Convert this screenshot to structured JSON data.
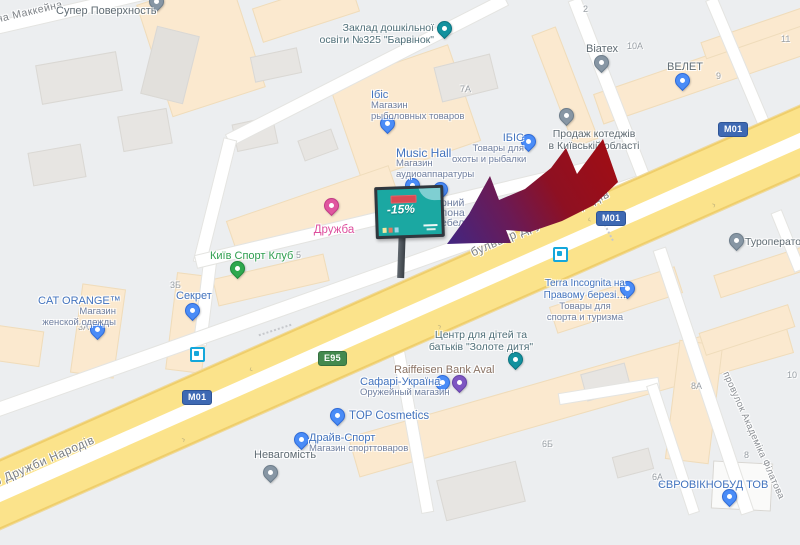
{
  "app": {
    "view": "map"
  },
  "colors": {
    "highway_yellow": "#FBE38B",
    "road_white": "#FFFFFF",
    "shield_m01_blue": "#3E69B3",
    "shield_e95_green": "#43894E",
    "shop_label_blue": "#4273BE",
    "gray_poi": "#5F6B73",
    "school_teal": "#4E6E78",
    "sport_green": "#2E9E4F",
    "entertainment_pink": "#DE4F9E",
    "bank_brown": "#8A7263",
    "arrow_red": "#A00D14",
    "arrow_purple": "#45257E",
    "billboard_teal": "#1BA8A2"
  },
  "streets": {
    "mccain": "на Маккейна",
    "boulevard": "бульвар Дружби Народів",
    "filatova": "провулок Академіка Філатова"
  },
  "shields": {
    "m01": "M01",
    "e95": "E95"
  },
  "billboard": {
    "discount": "-15%"
  },
  "building_numbers": [
    "2",
    "7А",
    "10А",
    "9",
    "11",
    "5",
    "3Б",
    "3А",
    "6Б",
    "8А",
    "8",
    "10",
    "6А"
  ],
  "pois": [
    {
      "lines": [
        "Супер Поверхность"
      ]
    },
    {
      "lines": [
        "Заклад дошкільної",
        "освіти №325 \"Барвінок\""
      ]
    },
    {
      "lines": [
        "Ібіс",
        "Магазин",
        "рыболовных товаров"
      ]
    },
    {
      "lines": [
        "Music Hall",
        "Магазин",
        "аудиоаппаратуры"
      ]
    },
    {
      "lines": [
        "ІБІС",
        "Товары для",
        "охоты и рыбалки"
      ]
    },
    {
      "lines": [
        "рний",
        "лона",
        "ебел"
      ]
    },
    {
      "lines": [
        "Віатех"
      ]
    },
    {
      "lines": [
        "ВЕЛЕТ"
      ]
    },
    {
      "lines": [
        "Продаж котеджів",
        "в Київській області"
      ]
    },
    {
      "lines": [
        "Туроператор"
      ]
    },
    {
      "lines": [
        "Terra Incognita на",
        "Правому березі…",
        "Товары для",
        "спорта и туризма"
      ]
    },
    {
      "lines": [
        "Київ Спорт Клуб"
      ]
    },
    {
      "lines": [
        "Дружба"
      ]
    },
    {
      "lines": [
        "CAT ORANGE™",
        "Магазин",
        "женской одежды"
      ]
    },
    {
      "lines": [
        "Секрет"
      ]
    },
    {
      "lines": [
        "Центр для дітей та",
        "батьків \"Золоте дитя\""
      ]
    },
    {
      "lines": [
        "Raiffeisen Bank Aval"
      ]
    },
    {
      "lines": [
        "Сафарі-Україна",
        "Оружейный магазин"
      ]
    },
    {
      "lines": [
        "TOP Cosmetics"
      ]
    },
    {
      "lines": [
        "Драйв-Спорт",
        "Магазин спорттоваров"
      ]
    },
    {
      "lines": [
        "Невагомість"
      ]
    },
    {
      "lines": [
        "ЄВРОВІКНОБУД ТОВ"
      ]
    }
  ]
}
